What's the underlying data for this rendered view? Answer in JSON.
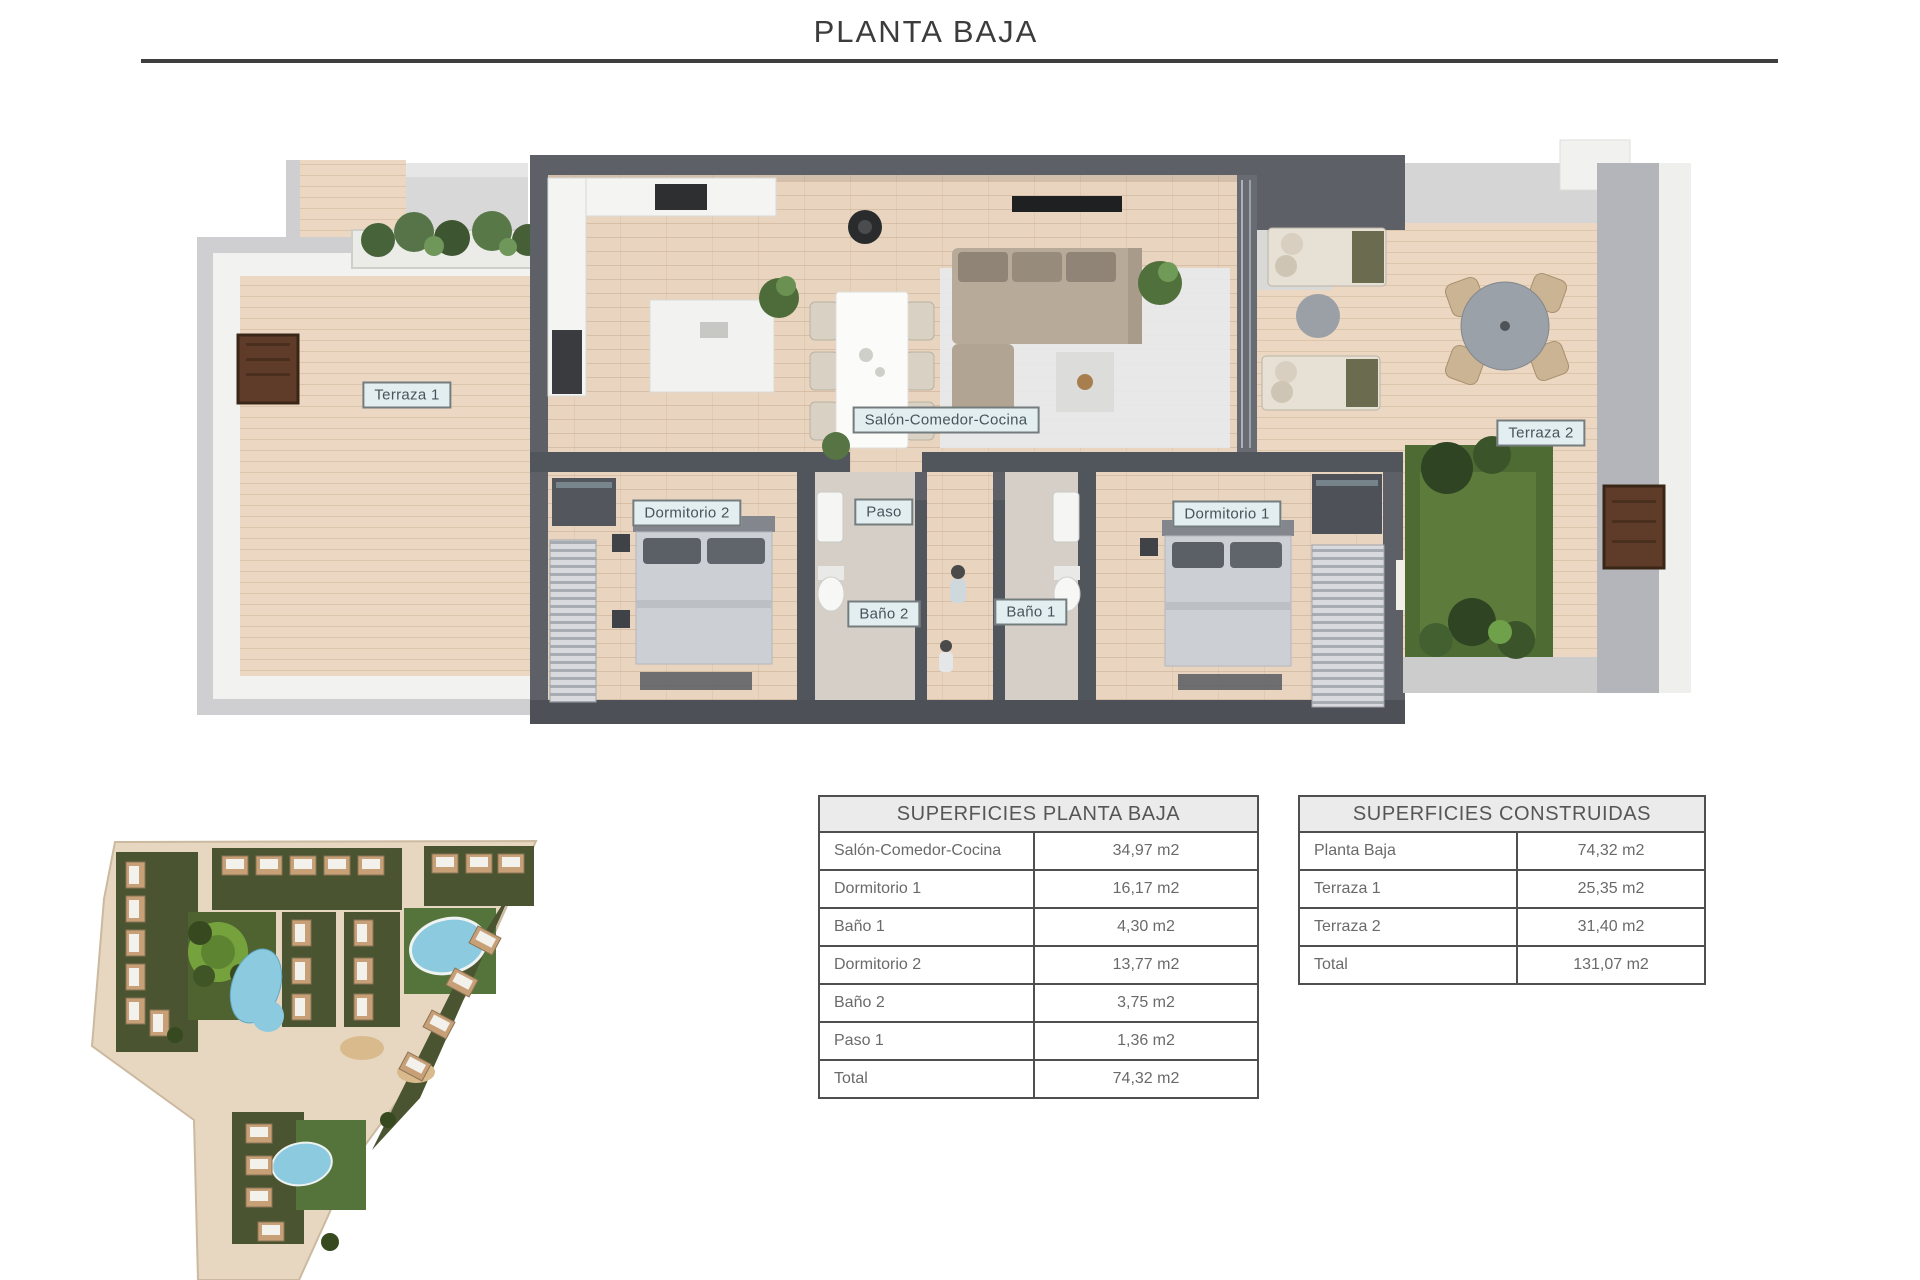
{
  "page": {
    "title": "PLANTA BAJA"
  },
  "floor_plan": {
    "room_labels": [
      {
        "id": "terraza-1",
        "label": "Terraza 1"
      },
      {
        "id": "salon-comedor-cocina",
        "label": "Salón-Comedor-Cocina"
      },
      {
        "id": "terraza-2",
        "label": "Terraza 2"
      },
      {
        "id": "dormitorio-2",
        "label": "Dormitorio 2"
      },
      {
        "id": "paso",
        "label": "Paso"
      },
      {
        "id": "dormitorio-1",
        "label": "Dormitorio 1"
      },
      {
        "id": "bano-2",
        "label": "Baño 2"
      },
      {
        "id": "bano-1",
        "label": "Baño 1"
      }
    ]
  },
  "surface_tables": [
    {
      "title": "SUPERFICIES PLANTA BAJA",
      "rows": [
        {
          "name": "Salón-Comedor-Cocina",
          "area": "34,97 m2"
        },
        {
          "name": "Dormitorio 1",
          "area": "16,17 m2"
        },
        {
          "name": "Baño 1",
          "area": "4,30 m2"
        },
        {
          "name": "Dormitorio 2",
          "area": "13,77 m2"
        },
        {
          "name": "Baño 2",
          "area": "3,75 m2"
        },
        {
          "name": "Paso 1",
          "area": "1,36 m2"
        },
        {
          "name": "Total",
          "area": "74,32 m2"
        }
      ]
    },
    {
      "title": "SUPERFICIES CONSTRUIDAS",
      "rows": [
        {
          "name": "Planta Baja",
          "area": "74,32 m2"
        },
        {
          "name": "Terraza 1",
          "area": "25,35 m2"
        },
        {
          "name": "Terraza 2",
          "area": "31,40 m2"
        },
        {
          "name": "Total",
          "area": "131,07 m2"
        }
      ]
    }
  ],
  "colors": {
    "wall_dark": "#5d6167",
    "wood_floor": "#e9d5bf",
    "label_bg": "#e3eef1",
    "garden_green": "#4e6b34",
    "pool_blue": "#8ccadf",
    "table_border": "#4f4f4f",
    "table_header_bg": "#ebebeb"
  }
}
